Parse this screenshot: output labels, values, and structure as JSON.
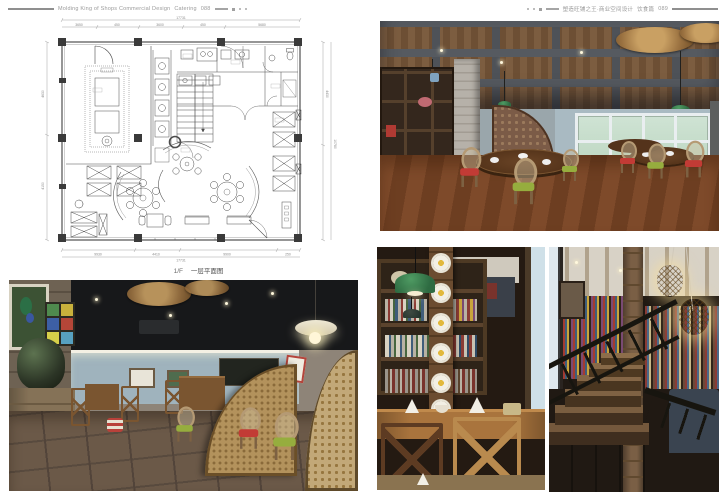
{
  "header": {
    "left": {
      "title_en": "Molding King of Shops Commercial Design",
      "section": "Catering",
      "page_no": "088"
    },
    "right": {
      "title_zh": "塑造旺铺之王·商业空间设计",
      "section_zh": "饮食篇",
      "page_no": "089"
    }
  },
  "floor_plan": {
    "caption_prefix": "1/F",
    "caption_text": "一层平面图",
    "dims": {
      "top_total": "17731",
      "top_segments": [
        "3650",
        "450",
        "3600",
        "450",
        "5680"
      ],
      "bottom_segments": [
        "9930",
        "4410",
        "9900",
        "250"
      ],
      "bottom_total": "17731",
      "left_segments": [
        "4630",
        "4150"
      ],
      "right_segments": [
        "4430",
        "10780"
      ]
    }
  },
  "photos": {
    "dining_hall": {
      "description": "Dining hall with timber plank ceiling and grey beam grid, woven rattan disc pendants, green enamel lamps, display shelving, grey brick pillar, white-framed windows and cane oval-back chairs with red and green cushions around dark wood tables"
    },
    "dining_room": {
      "description": "Dining room with black ceiling, rattan disc pendants, blue-grey walls with cove light and framed pictures, stained glass panel, large glazed jar on timber cabinet, woven fan screens and cross-back chairs on dark tiled floor"
    },
    "bookshelf_corner": {
      "description": "Bookshelf corner with timber column decorated with white daisies, green enamel pendant lamps, shelves of books, bright window and oak cross-back chairs at a set table"
    },
    "staircase": {
      "description": "Dark timber staircase with black steel balustrade, central timber post, woven basket pendant lights and a book-lined wall beyond"
    }
  },
  "palette": {
    "wood": "#7a5130",
    "ceiling_dark": "#1a1a1c",
    "wall_blue": "#a3b4bd",
    "lamp_green": "#2e7d46",
    "cushion_red": "#c23b35",
    "cushion_green": "#96ad3e",
    "rattan": "#b08a4e"
  }
}
